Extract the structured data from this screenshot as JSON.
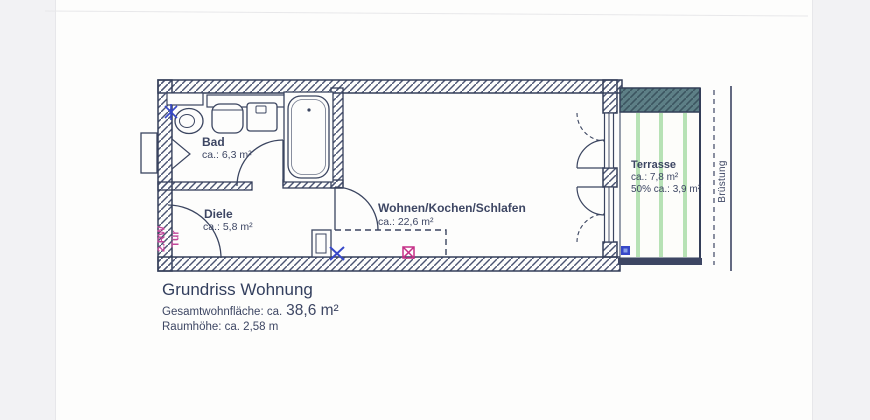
{
  "colors": {
    "ink": "#3d4663",
    "magenta_note": "#c2479a",
    "blue_symbol": "#3748c8",
    "red_symbol": "#c52f86",
    "terrace_stripe_green": "#b7e2b5",
    "parapet_band_teal": "#5d7f86",
    "paper": "#fdfdfc",
    "scanner_margin": "#f2f2f4"
  },
  "rooms": {
    "bad": {
      "name": "Bad",
      "area": "ca.: 6,3 m²"
    },
    "diele": {
      "name": "Diele",
      "area": "ca.: 5,8 m²"
    },
    "wohnen": {
      "name": "Wohnen/Kochen/Schlafen",
      "area": "ca.: 22,6 m²"
    },
    "terrasse": {
      "name": "Terrasse",
      "area": "ca.: 7,8 m²",
      "area_half": "50% ca.: 3,9 m²"
    }
  },
  "annotations": {
    "rw_tuer_line1": "2.RW",
    "rw_tuer_line2": "Tür",
    "bruestung": "Brüstung"
  },
  "footer": {
    "title": "Grundriss Wohnung",
    "total_area_label": "Gesamtwohnfläche: ca.",
    "total_area_value": "38,6 m²",
    "room_height": "Raumhöhe: ca. 2,58 m"
  }
}
